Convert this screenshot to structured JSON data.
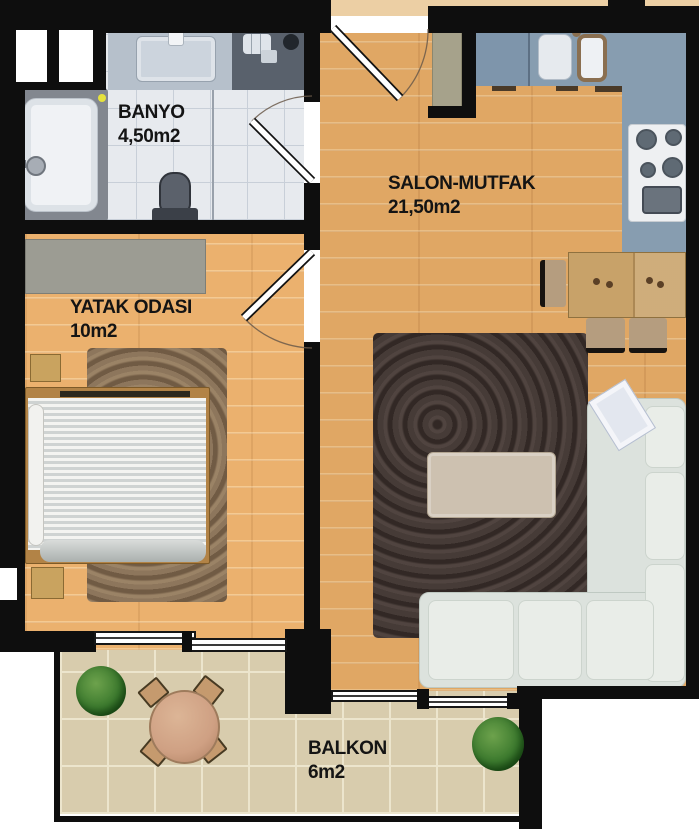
{
  "plan": {
    "rooms": [
      {
        "id": "banyo",
        "label": "BANYO",
        "area": "4,50m2"
      },
      {
        "id": "salon-mutfak",
        "label": "SALON-MUTFAK",
        "area": "21,50m2"
      },
      {
        "id": "yatak-odasi",
        "label": "YATAK ODASI",
        "area": "10m2"
      },
      {
        "id": "balkon",
        "label": "BALKON",
        "area": "6m2"
      }
    ]
  },
  "colors": {
    "wall": "#0e0e0e",
    "wood": "#e0a764",
    "corridor": "#eccfa4",
    "bath-tile": "#e7eaee",
    "bath-grout": "#c8cfd8",
    "balcony-tile": "#d8ccad",
    "balcony-grout": "#ece5cd",
    "counter": "#879db0",
    "sofa": "#dce2dd",
    "rug-dark": "#463b37",
    "rug-brown": "#8d765c",
    "wardrobe": "#9c9c93",
    "cabinet-olive": "#a6a28b",
    "table-wood": "#c8a269",
    "balcony-table": "#cfa083",
    "plant": "#3c7a2e",
    "label-text": "#141414"
  }
}
